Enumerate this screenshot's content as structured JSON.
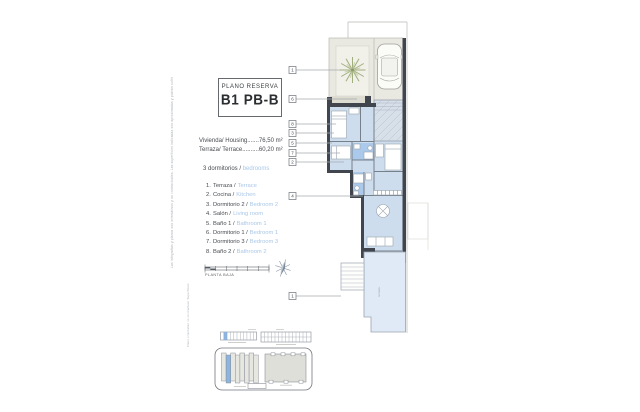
{
  "title_block": {
    "label": "PLANO RESERVA",
    "code": "B1 PB-B"
  },
  "areas": {
    "housing": "Vivienda/ Housing.......76,50 m²",
    "terrace": "Terraza/ Terrace..........60,20 m²"
  },
  "bedrooms": {
    "es": "3 dormitorios /",
    "en": "bedrooms"
  },
  "legend": [
    {
      "num": "1.",
      "es": "Terraza /",
      "en": "Terrace"
    },
    {
      "num": "2.",
      "es": "Cocina /",
      "en": "Kitchen"
    },
    {
      "num": "3.",
      "es": "Dormitorio 2 /",
      "en": "Bedroom 2"
    },
    {
      "num": "4.",
      "es": "Salón /",
      "en": "Living room"
    },
    {
      "num": "5.",
      "es": "Baño 1 /",
      "en": "Bathroom 1"
    },
    {
      "num": "6.",
      "es": "Dormitorio 1 /",
      "en": "Bedroom 1"
    },
    {
      "num": "7.",
      "es": "Dormitorio 3 /",
      "en": "Bedroom 3"
    },
    {
      "num": "8.",
      "es": "Baño 2 /",
      "en": "Bathroom 2"
    }
  ],
  "scale": {
    "caption": "PLANTA BAJA"
  },
  "plan": {
    "callouts": {
      "c1": "1",
      "c6": "6",
      "c8": "8",
      "c3": "3",
      "c5": "5",
      "c7": "7",
      "c2": "2",
      "c4": "4",
      "c1b": "1"
    },
    "terrace_label": "terraza"
  },
  "micro_text": {
    "left": "Las infografías y planos son orientativos y no contractuales. Las superficies indicadas son aproximadas y podrán sufrir modificaciones por razones técnicas, jurídicas o comerciales durante el desarrollo de la obra. El mobiliario y la jardinería son decorativos.",
    "bottom": "Plano orientativo no contractual. Superficies aproximadas."
  },
  "colors": {
    "room_blue": "#cdddee",
    "terrace_blue": "#dfeaf6",
    "bath_blue": "#abc9ea",
    "wall": "#41464e",
    "accent_blue": "#a9c7e8",
    "patio_gray": "#e9e8e1",
    "site_highlight": "#8ab4e2"
  }
}
